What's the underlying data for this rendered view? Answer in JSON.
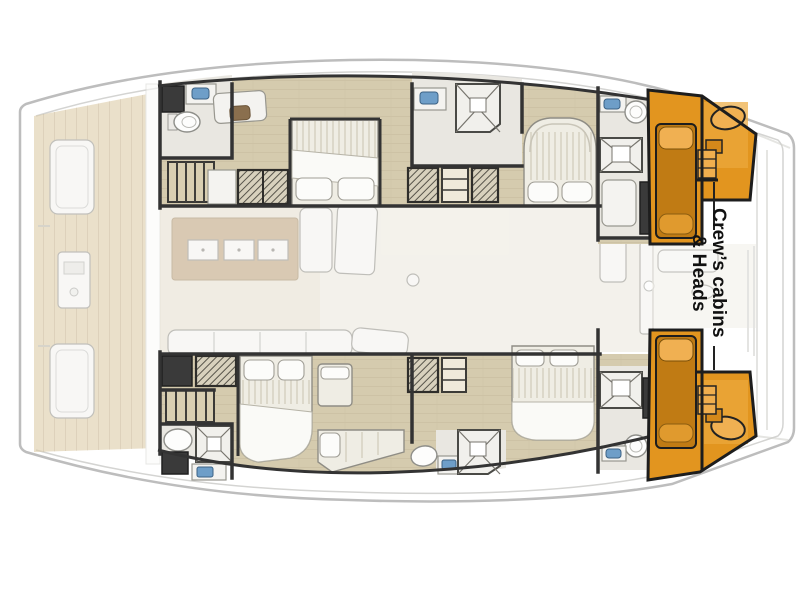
{
  "page": {
    "background": "#ffffff",
    "type": "catamaran-deck-plan"
  },
  "highlight_label": {
    "line1": "Crew’s cabins",
    "line2": "& Heads"
  },
  "colors": {
    "hull_fill": "#ffffff",
    "hull_stroke": "#bdbdbd",
    "wall": "#333333",
    "wood_floor": "#d5cbae",
    "floor_light": "#e9e7e1",
    "deck_wood": "#ddcca8",
    "salon_floor": "#edeadf",
    "galley_island": "#c2a985",
    "furniture": "#f4f3f0",
    "furniture_stroke": "#98978f",
    "mattress": "#efede4",
    "sink_blue": "#6e9ec8",
    "highlight": "#e2951f",
    "highlight_dark": "#c07b14",
    "highlight_light": "#f0b052",
    "label_text": "#111111",
    "leader": "#222222"
  }
}
